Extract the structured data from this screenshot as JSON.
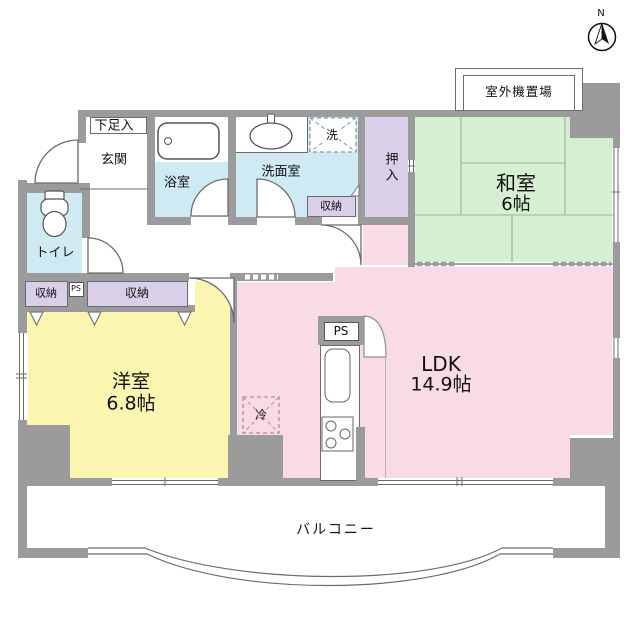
{
  "compass": {
    "label": "N"
  },
  "outdoor_unit": {
    "label": "室外機置場"
  },
  "rooms": {
    "washitsu": {
      "name": "和室",
      "size": "6帖"
    },
    "ldk": {
      "name": "LDK",
      "size": "14.9帖"
    },
    "youshitsu": {
      "name": "洋室",
      "size": "6.8帖"
    },
    "balcony": {
      "name": "バルコニー"
    },
    "genkan": {
      "name": "玄関"
    },
    "getabako": {
      "name": "下足入"
    },
    "bathroom": {
      "name": "浴室"
    },
    "washroom": {
      "name": "洗面室"
    },
    "toilet": {
      "name": "トイレ"
    },
    "oshiire": {
      "name": "押入"
    }
  },
  "storage": {
    "closet_hall": "収納",
    "closet_left": "収納",
    "closet_mid": "収納"
  },
  "fixtures": {
    "washer": "洗",
    "fridge": "冷",
    "ps_small": "PS",
    "ps_kitchen": "PS"
  },
  "colors": {
    "wall": "#9b9b9b",
    "wet_area": "#cfeaf3",
    "tatami_room": "#d6eed2",
    "ldk_room": "#f9dbe8",
    "western_room": "#fbf5b2",
    "closet": "#d9cfe8"
  }
}
